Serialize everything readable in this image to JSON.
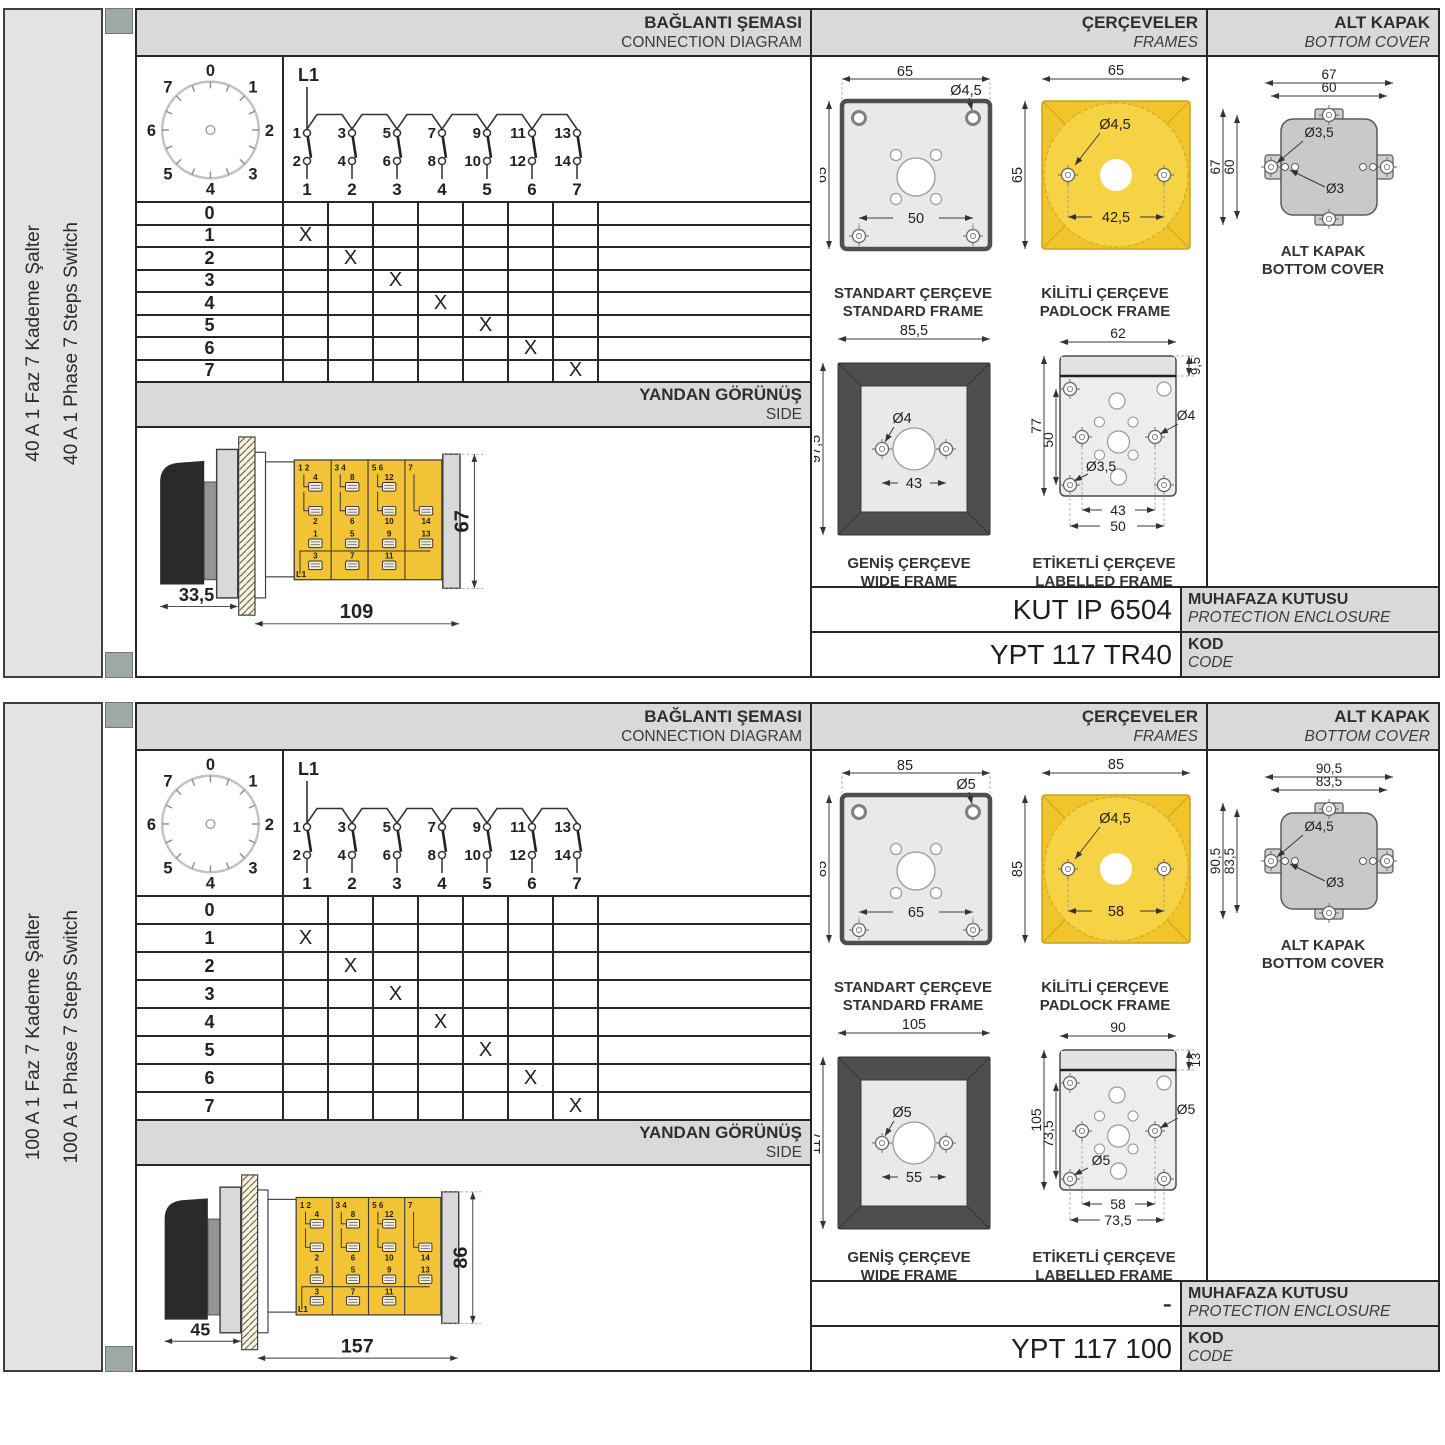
{
  "labels": {
    "connection_tr": "BAĞLANTI ŞEMASI",
    "connection_en": "CONNECTION DIAGRAM",
    "frames_tr": "ÇERÇEVELER",
    "frames_en": "FRAMES",
    "cover_tr": "ALT KAPAK",
    "cover_en": "BOTTOM COVER",
    "side_tr": "YANDAN GÖRÜNÜŞ",
    "side_en": "SIDE",
    "enclosure_tr": "MUHAFAZA KUTUSU",
    "enclosure_en": "PROTECTION ENCLOSURE",
    "kod_tr": "KOD",
    "kod_en": "CODE",
    "standard_tr": "STANDART ÇERÇEVE",
    "standard_en": "STANDARD FRAME",
    "padlock_tr": "KİLİTLİ ÇERÇEVE",
    "padlock_en": "PADLOCK FRAME",
    "wide_tr": "GENİŞ ÇERÇEVE",
    "wide_en": "WIDE FRAME",
    "labelled_tr": "ETİKETLİ ÇERÇEVE",
    "labelled_en": "LABELLED FRAME",
    "cover_cap_tr": "ALT KAPAK",
    "cover_cap_en": "BOTTOM COVER",
    "phase": "L1"
  },
  "colors": {
    "yellow": "#F1C335",
    "yellow_light": "#F6D245",
    "frame_dark": "#4E4E4E",
    "header_gray": "#D9D9D9",
    "cover_gray": "#C9C9C9",
    "spine_gray": "#9EA8A6"
  },
  "diagram": {
    "dial_positions": [
      "0",
      "1",
      "2",
      "3",
      "4",
      "5",
      "6",
      "7"
    ],
    "top_terminals": [
      "1",
      "3",
      "5",
      "7",
      "9",
      "11",
      "13"
    ],
    "bottom_terminals": [
      "2",
      "4",
      "6",
      "8",
      "10",
      "12",
      "14"
    ],
    "switch_numbers": [
      "1",
      "2",
      "3",
      "4",
      "5",
      "6",
      "7"
    ],
    "table_rows": [
      {
        "pos": "0",
        "marks": [
          "",
          "",
          "",
          "",
          "",
          "",
          ""
        ]
      },
      {
        "pos": "1",
        "marks": [
          "X",
          "",
          "",
          "",
          "",
          "",
          ""
        ]
      },
      {
        "pos": "2",
        "marks": [
          "",
          "X",
          "",
          "",
          "",
          "",
          ""
        ]
      },
      {
        "pos": "3",
        "marks": [
          "",
          "",
          "X",
          "",
          "",
          "",
          ""
        ]
      },
      {
        "pos": "4",
        "marks": [
          "",
          "",
          "",
          "X",
          "",
          "",
          ""
        ]
      },
      {
        "pos": "5",
        "marks": [
          "",
          "",
          "",
          "",
          "X",
          "",
          ""
        ]
      },
      {
        "pos": "6",
        "marks": [
          "",
          "",
          "",
          "",
          "",
          "X",
          ""
        ]
      },
      {
        "pos": "7",
        "marks": [
          "",
          "",
          "",
          "",
          "",
          "",
          "X"
        ]
      }
    ],
    "side_view": {
      "seg_tops": [
        "1  2",
        "3  4",
        "5  6",
        "7"
      ],
      "upper": [
        "4",
        "8",
        "12"
      ],
      "mid": [
        "2",
        "6",
        "10",
        "14"
      ],
      "low_a": [
        "1",
        "5",
        "9",
        "13"
      ],
      "low_b": [
        "3",
        "7",
        "11"
      ],
      "phase": "L1"
    }
  },
  "panels": [
    {
      "title_tr": "40 A 1 Faz 7 Kademe Şalter",
      "title_en": "40 A 1 Phase 7 Steps Switch",
      "side_view": {
        "d1": "33,5",
        "d2": "109",
        "d3": "67"
      },
      "standard": {
        "w": "65",
        "h": "65",
        "hole": "Ø4,5",
        "pitch": "50"
      },
      "padlock": {
        "w": "65",
        "h": "65",
        "hole": "Ø4,5",
        "pitch": "42,5"
      },
      "wide": {
        "w": "85,5",
        "h": "97,5",
        "hole": "Ø4",
        "pitch": "43"
      },
      "labelled": {
        "w": "62",
        "top": "9,5",
        "h": "77",
        "inner_h": "50",
        "hole_r": "Ø4",
        "hole_bl": "Ø3,5",
        "pitch1": "43",
        "pitch2": "50"
      },
      "cover": {
        "w_out": "67",
        "w_in": "60",
        "h_out": "67",
        "h_in": "60",
        "hole1": "Ø3,5",
        "hole2": "Ø3"
      },
      "enclosure_code": "KUT IP 6504",
      "code": "YPT 117 TR40"
    },
    {
      "title_tr": "100 A 1 Faz 7 Kademe Şalter",
      "title_en": "100 A 1 Phase 7 Steps Switch",
      "side_view": {
        "d1": "45",
        "d2": "157",
        "d3": "86"
      },
      "standard": {
        "w": "85",
        "h": "85",
        "hole": "Ø5",
        "pitch": "65"
      },
      "padlock": {
        "w": "85",
        "h": "85",
        "hole": "Ø4,5",
        "pitch": "58"
      },
      "wide": {
        "w": "105",
        "h": "117",
        "hole": "Ø5",
        "pitch": "55"
      },
      "labelled": {
        "w": "90",
        "top": "13",
        "h": "105",
        "inner_h": "73,5",
        "hole_r": "Ø5",
        "hole_bl": "Ø5",
        "pitch1": "58",
        "pitch2": "73,5"
      },
      "cover": {
        "w_out": "90,5",
        "w_in": "83,5",
        "h_out": "90,5",
        "h_in": "83,5",
        "hole1": "Ø4,5",
        "hole2": "Ø3"
      },
      "enclosure_code": "-",
      "code": "YPT 117 100"
    }
  ]
}
